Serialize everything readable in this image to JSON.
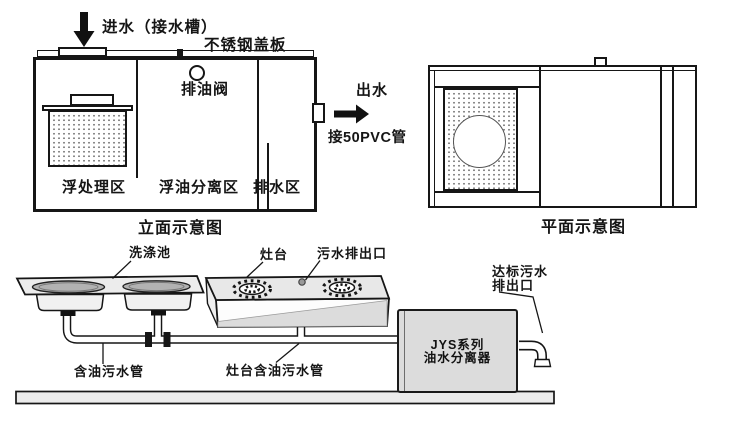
{
  "colors": {
    "line": "#1a1a1a",
    "panel_gray": "#dcdcdc",
    "counter_gray": "#ececec",
    "sink_gray": "#b2b2b2",
    "floor_gray": "#ebebeb"
  },
  "elevation": {
    "title": "立面示意图",
    "inflow_label": "进水（接水槽）",
    "cover_label": "不锈钢盖板",
    "oil_valve_label": "排油阀",
    "zone_float_treatment": "浮处理区",
    "zone_oil_separation": "浮油分离区",
    "zone_drainage": "排水区",
    "outflow_label": "出水",
    "outflow_pipe_label": "接50PVC管"
  },
  "plan": {
    "title": "平面示意图"
  },
  "piping": {
    "sink_label": "洗涤池",
    "stove_label": "灶台",
    "stove_outlet_label": "污水排出口",
    "oily_pipe_label": "含油污水管",
    "stove_oily_pipe_label": "灶台含油污水管",
    "separator_name_line1": "JYS系列",
    "separator_name_line2": "油水分离器",
    "discharge_line1": "达标污水",
    "discharge_line2": "排出口"
  }
}
